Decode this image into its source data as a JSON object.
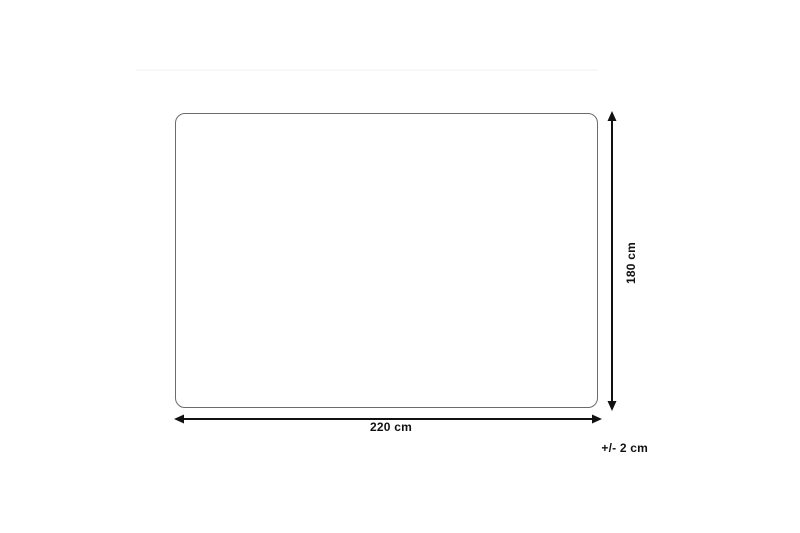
{
  "diagram": {
    "type": "product-dimension-diagram",
    "width_label": "220 cm",
    "height_label": "180 cm",
    "tolerance_label": "+/- 2 cm"
  },
  "colors": {
    "background": "#ffffff",
    "outline": "#6b6b6b",
    "arrow": "#111111",
    "text": "#111111",
    "divider": "#f8f8f8"
  }
}
